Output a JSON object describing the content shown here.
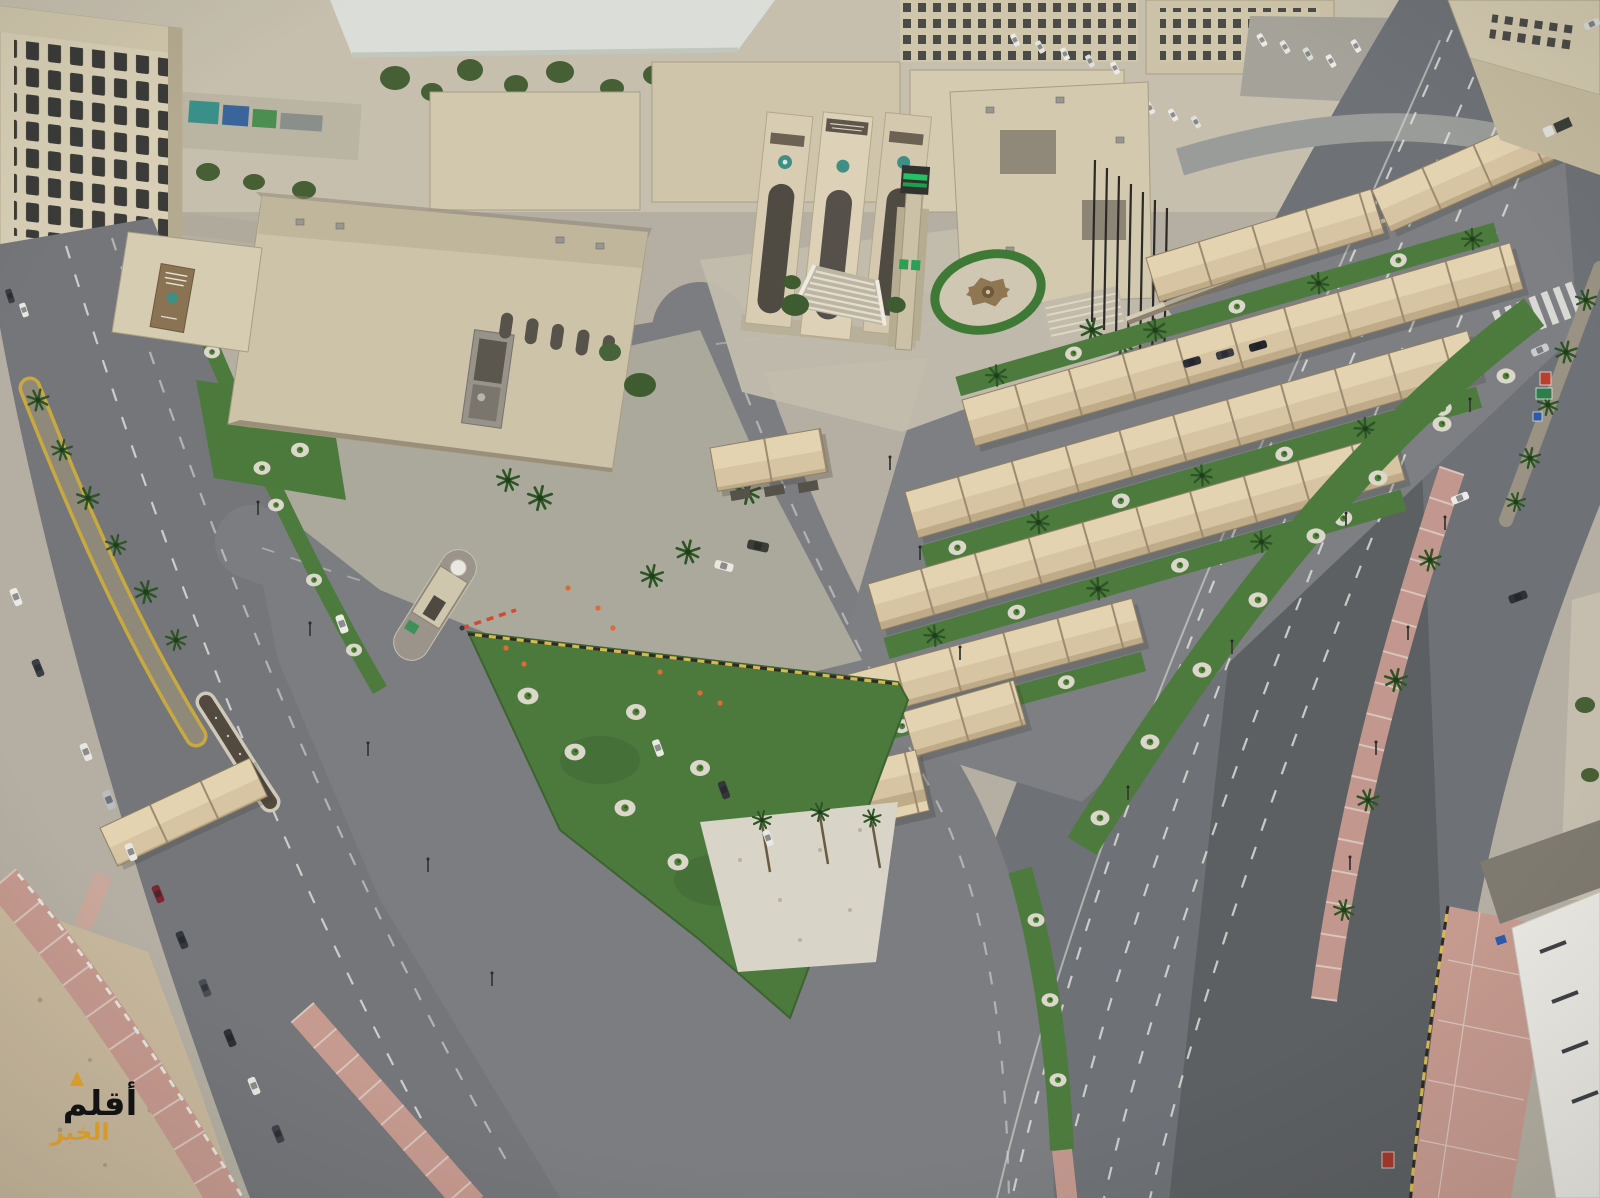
{
  "watermark": {
    "line1": "أقلم",
    "line2": "الخبر",
    "line1_color": "#141414",
    "line2_color": "#e3a42e"
  },
  "scene": {
    "type": "aerial-drone-photograph",
    "lighting": "overcast daylight",
    "landmarks": {
      "municipal_complex": "beige government complex with triple arched entrance pylons and Arabic sign boards",
      "clock_tower": "slender tower with dark cap and green digital display",
      "plaza_circle": "circular plaza with eight-point star mosaic inside a green ring",
      "grand_staircase": "fan staircase with white balustrades below the entrance",
      "parking_canopies": "long parallel rows of tan tensile parking shades",
      "guard_house": "small gatehouse with red-white barrier on the west entrance median",
      "green_islands": "lawn islands with palms and young trees in white-gravel circles",
      "west_avenue": "palm-median avenue with a column of parallel-parked cars",
      "east_highway": "wide multi-lane highway with median palms, crosswalk and road signs",
      "sand_lot": "bare sand corner at bottom-left",
      "pink_sidewalks": "rose-tiled pedestrian sidewalks with yellow curbs"
    },
    "palette": {
      "asphalt": "#73757a",
      "asphalt_dark": "#5a5d61",
      "concrete_paving": "#aeaa9e",
      "building_wall": "#d5cbb1",
      "building_shadow": "#b2a88d",
      "canopy": "#d6c4a2",
      "canopy_light": "#e3d3b1",
      "lawn": "#4c7a3c",
      "palm_green": "#2e5526",
      "gravel_white": "#dcd8cb",
      "sand": "#c7b89d",
      "sidewalk_pink": "#c59a8f",
      "curb_yellow": "#d9b94e",
      "clock_led_green": "#27c163",
      "sign_green": "#2f7d4d",
      "sign_blue": "#2b5cab",
      "sign_red": "#b8402f",
      "car_maroon": "#7b2732"
    },
    "counts": {
      "canopy_rows": 9,
      "west_parked_cars": 11,
      "highway_vehicles": 5,
      "flagpoles": 7
    }
  }
}
